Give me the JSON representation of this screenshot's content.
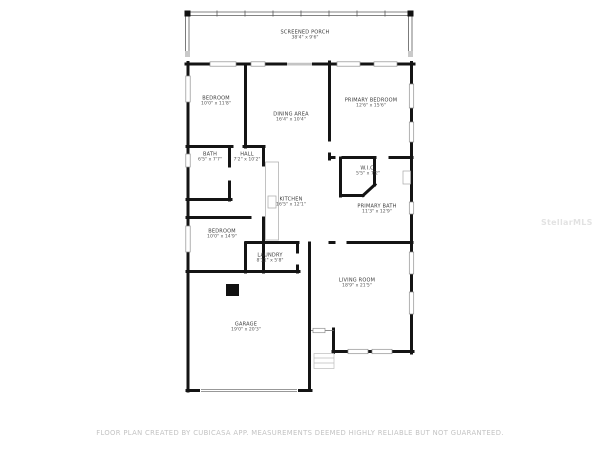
{
  "plan_title": "Floor plan",
  "colors": {
    "wall": "#141414",
    "window_outline": "#8f8f8f",
    "label_text": "#3a3a3a",
    "footer_text": "#c3c3c3"
  },
  "rooms": [
    {
      "name": "SCREENED PORCH",
      "dims": "38'4\" x 9'6\""
    },
    {
      "name": "BEDROOM",
      "dims": "10'0\" x 11'8\""
    },
    {
      "name": "DINING AREA",
      "dims": "16'4\" x 10'4\""
    },
    {
      "name": "PRIMARY BEDROOM",
      "dims": "12'6\" x 15'6\""
    },
    {
      "name": "BATH",
      "dims": "6'5\" x 7'7\""
    },
    {
      "name": "HALL",
      "dims": "7'2\" x 10'2\""
    },
    {
      "name": "W.I.C.",
      "dims": "5'5\" x 7'2\""
    },
    {
      "name": "KITCHEN",
      "dims": "16'5\" x 12'1\""
    },
    {
      "name": "PRIMARY BATH",
      "dims": "11'3\" x 12'9\""
    },
    {
      "name": "BEDROOM",
      "dims": "10'0\" x 14'9\""
    },
    {
      "name": "LAUNDRY",
      "dims": "8'11\" x 5'8\""
    },
    {
      "name": "LIVING ROOM",
      "dims": "18'9\" x 21'5\""
    },
    {
      "name": "GARAGE",
      "dims": "19'0\" x 20'3\""
    }
  ],
  "watermark": {
    "text": "StellarMLS"
  },
  "footer": {
    "disclaimer": "FLOOR PLAN CREATED BY CUBICASA APP. MEASUREMENTS DEEMED HIGHLY RELIABLE BUT NOT GUARANTEED."
  }
}
